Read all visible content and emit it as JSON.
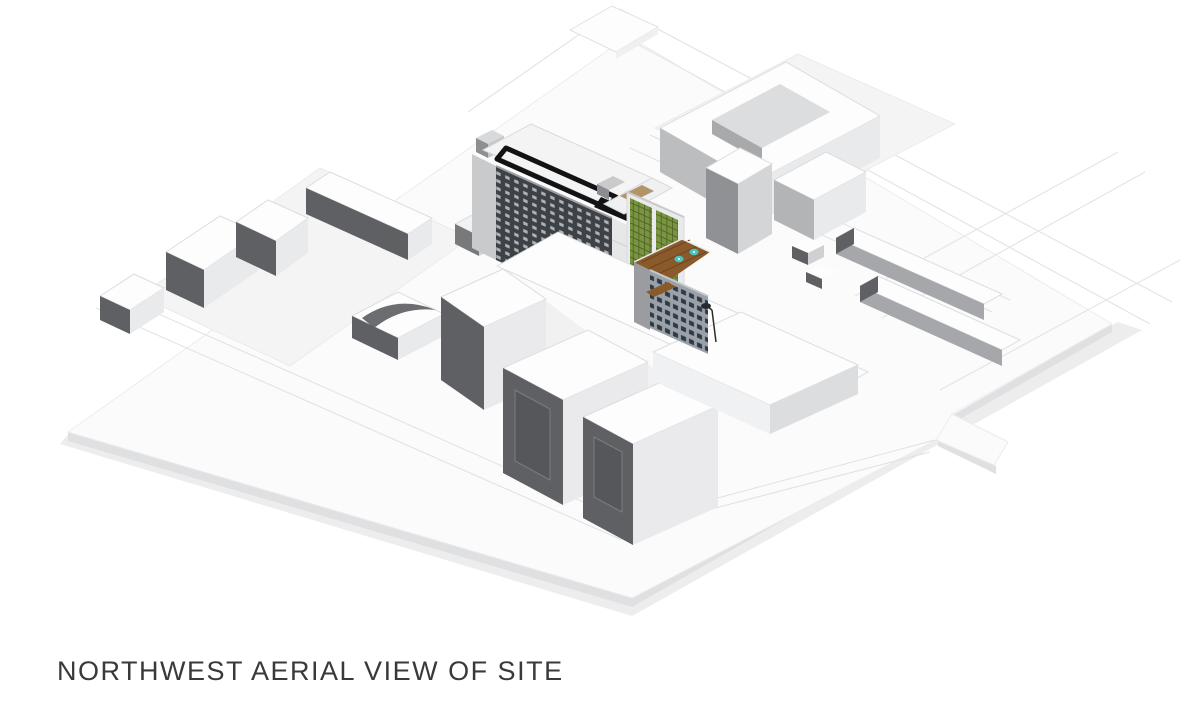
{
  "caption": {
    "text": "NORTHWEST AERIAL VIEW OF SITE"
  },
  "colors": {
    "background": "#ffffff",
    "plate_top": "#fbfbfc",
    "plate_side": "#dfe0e2",
    "plate_shadow": "#ededee",
    "block_patch": "#f4f4f5",
    "road_curb": "#e0e1e3",
    "context_outline": "#e4e5e7",
    "white_roof": "#fdfdfe",
    "face_dark": "#5e6063",
    "face_medium": "#bcbdbf",
    "face_light": "#e9eaeb",
    "tower_facade": "#3e4246",
    "tower_window": "#b9c0c6",
    "roof_band": "#121314",
    "tower_roof": "#f4f4f5",
    "green_glass": "#7a9440",
    "green_grid": "#4f6428",
    "mullion_white": "#e9eaeb",
    "tan_panel": "#b29468",
    "wood_deck": "#8a5a2b",
    "wood_deck_dark": "#6e4520",
    "teal_umbrella": "#45c6c0",
    "lower_facade": "#9aa1a8",
    "lower_window": "#232e3a",
    "lamp_black": "#2a2a2c",
    "recess_panel": "#55575a",
    "caption_text": "#39393b"
  }
}
